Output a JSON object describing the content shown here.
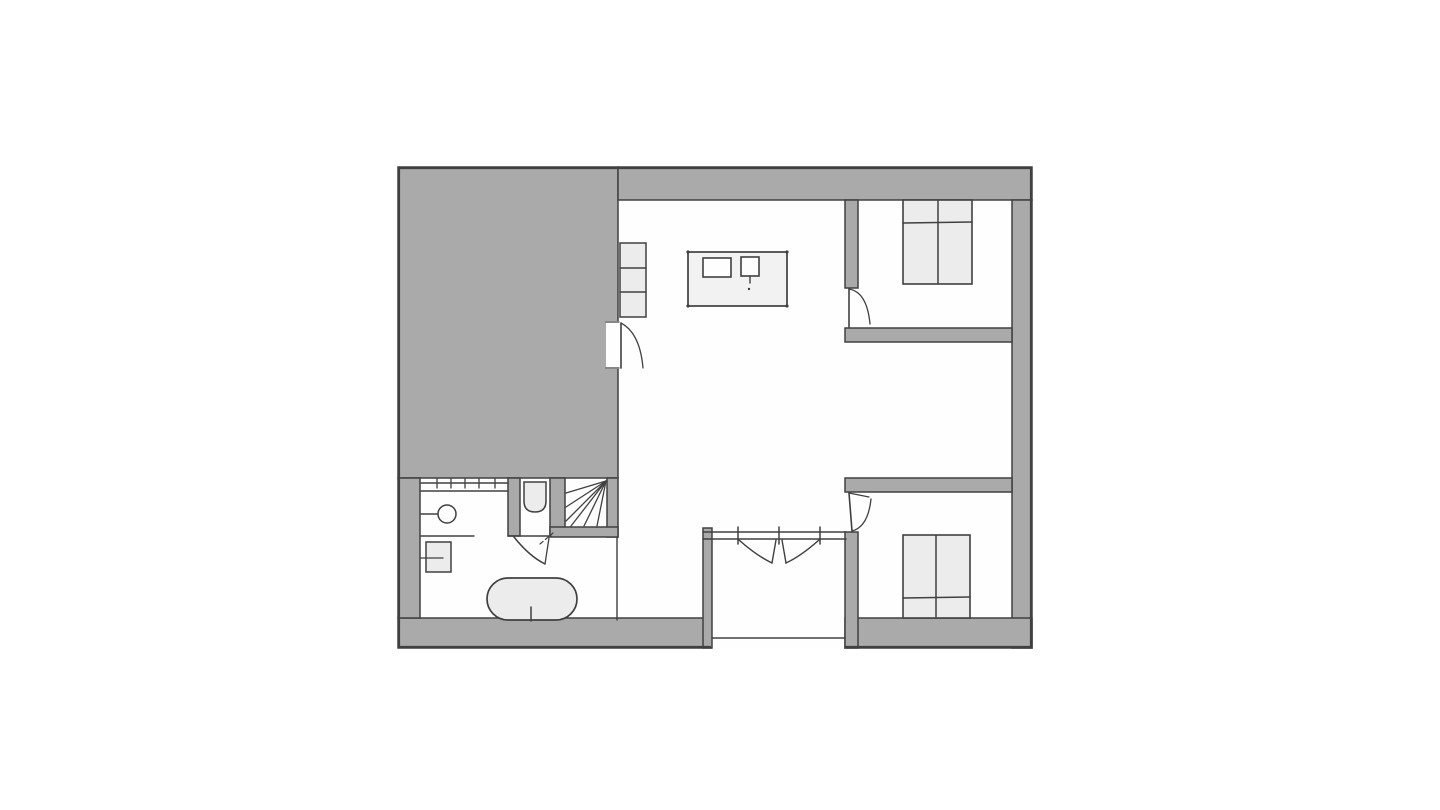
{
  "document": {
    "kind": "architectural floor plan, hand-drawn style, no text labels",
    "rooms": [
      "living-kitchen room",
      "bedroom top-right",
      "bedroom bottom-right",
      "bathroom",
      "wc",
      "stairwell",
      "entrance vestibule"
    ],
    "annex_note": "large solid gray block occupies top-left quadrant"
  },
  "colors": {
    "background": "#ffffff",
    "paper": "#fefefe",
    "wall": "#aaaaaa",
    "line": "#404040",
    "furniture": "#ececec",
    "island": "#f2f2f2"
  },
  "floorplan": {
    "canvas": {
      "width": 1440,
      "height": 810
    },
    "shapes": [
      {
        "name": "plan-paper",
        "type": "rect",
        "x": 398,
        "y": 167,
        "w": 634,
        "h": 481,
        "fill": "paper"
      },
      {
        "name": "gray-annex-block",
        "type": "rect",
        "x": 398,
        "y": 167,
        "w": 220,
        "h": 311,
        "fill": "wall",
        "stroke": "line",
        "sw": 1.5
      },
      {
        "name": "wall-top",
        "type": "rect",
        "x": 618,
        "y": 167,
        "w": 414,
        "h": 33,
        "fill": "wall",
        "stroke": "line",
        "sw": 1.5
      },
      {
        "name": "wall-right",
        "type": "rect",
        "x": 1012,
        "y": 200,
        "w": 20,
        "h": 448,
        "fill": "wall",
        "stroke": "line",
        "sw": 1.5
      },
      {
        "name": "wall-bottom-left",
        "type": "rect",
        "x": 398,
        "y": 618,
        "w": 313,
        "h": 30,
        "fill": "wall",
        "stroke": "line",
        "sw": 1.5
      },
      {
        "name": "wall-bottom-right",
        "type": "rect",
        "x": 845,
        "y": 618,
        "w": 187,
        "h": 30,
        "fill": "wall",
        "stroke": "line",
        "sw": 1.5
      },
      {
        "name": "wall-bathroom-left",
        "type": "rect",
        "x": 398,
        "y": 478,
        "w": 22,
        "h": 140,
        "fill": "wall",
        "stroke": "line",
        "sw": 1.5
      },
      {
        "name": "wall-wc-left",
        "type": "rect",
        "x": 508,
        "y": 478,
        "w": 12,
        "h": 58,
        "fill": "wall",
        "stroke": "line",
        "sw": 1.5
      },
      {
        "name": "wall-wc-stair",
        "type": "rect",
        "x": 550,
        "y": 478,
        "w": 15,
        "h": 58,
        "fill": "wall",
        "stroke": "line",
        "sw": 1.5
      },
      {
        "name": "wall-stair-right",
        "type": "rect",
        "x": 607,
        "y": 478,
        "w": 11,
        "h": 59,
        "fill": "wall",
        "stroke": "line",
        "sw": 1.5
      },
      {
        "name": "wall-stair-bottom",
        "type": "rect",
        "x": 550,
        "y": 527,
        "w": 68,
        "h": 10,
        "fill": "wall",
        "stroke": "line",
        "sw": 1.5
      },
      {
        "name": "wall-vestibule-left",
        "type": "rect",
        "x": 703,
        "y": 528,
        "w": 9,
        "h": 120,
        "fill": "wall",
        "stroke": "line",
        "sw": 1.5
      },
      {
        "name": "wall-bedroom1-left",
        "type": "rect",
        "x": 845,
        "y": 200,
        "w": 13,
        "h": 88,
        "fill": "wall",
        "stroke": "line",
        "sw": 1.5
      },
      {
        "name": "wall-bedroom1-bottom",
        "type": "rect",
        "x": 845,
        "y": 328,
        "w": 167,
        "h": 14,
        "fill": "wall",
        "stroke": "line",
        "sw": 1.5
      },
      {
        "name": "wall-bedroom2-top",
        "type": "rect",
        "x": 845,
        "y": 478,
        "w": 167,
        "h": 14,
        "fill": "wall",
        "stroke": "line",
        "sw": 1.5
      },
      {
        "name": "wall-bedroom2-left",
        "type": "rect",
        "x": 845,
        "y": 532,
        "w": 13,
        "h": 116,
        "fill": "wall",
        "stroke": "line",
        "sw": 1.5
      },
      {
        "name": "outline-top",
        "type": "line",
        "p": [
          399,
          168,
          1031,
          168
        ],
        "stroke": "line",
        "sw": 2.2
      },
      {
        "name": "outline-left",
        "type": "line",
        "p": [
          399,
          168,
          399,
          647
        ],
        "stroke": "line",
        "sw": 2.2
      },
      {
        "name": "outline-right",
        "type": "line",
        "p": [
          1031,
          168,
          1031,
          647
        ],
        "stroke": "line",
        "sw": 2.2
      },
      {
        "name": "outline-bottom-left",
        "type": "line",
        "p": [
          399,
          647,
          710,
          647
        ],
        "stroke": "line",
        "sw": 2.2
      },
      {
        "name": "outline-bottom-right",
        "type": "line",
        "p": [
          846,
          647,
          1031,
          647
        ],
        "stroke": "line",
        "sw": 2.2
      },
      {
        "name": "living-room-door-opening",
        "type": "rect",
        "x": 606,
        "y": 321,
        "w": 13,
        "h": 48,
        "fill": "paper"
      },
      {
        "name": "living-room-door-jamb-top",
        "type": "line",
        "p": [
          606,
          322,
          619,
          322
        ],
        "stroke": "line",
        "sw": 1.3
      },
      {
        "name": "living-room-door-jamb-bottom",
        "type": "line",
        "p": [
          606,
          368,
          619,
          368
        ],
        "stroke": "line",
        "sw": 1.3
      },
      {
        "name": "living-room-door-leaf",
        "type": "line",
        "p": [
          621,
          323,
          621,
          368
        ],
        "stroke": "line",
        "sw": 1.6
      },
      {
        "name": "living-room-door-swing",
        "type": "path",
        "d": "M621,323 Q640,333 643,368",
        "stroke": "line",
        "sw": 1.3
      },
      {
        "name": "shelf-unit",
        "type": "rect",
        "x": 620,
        "y": 243,
        "w": 26,
        "h": 74,
        "fill": "furniture",
        "stroke": "line",
        "sw": 1.5
      },
      {
        "name": "shelf-divider-1",
        "type": "line",
        "p": [
          620,
          268,
          646,
          268
        ],
        "stroke": "line",
        "sw": 1.4
      },
      {
        "name": "shelf-divider-2",
        "type": "line",
        "p": [
          620,
          292,
          646,
          292
        ],
        "stroke": "line",
        "sw": 1.4
      },
      {
        "name": "kitchen-island",
        "type": "rect",
        "x": 688,
        "y": 252,
        "w": 99,
        "h": 54,
        "fill": "island",
        "stroke": "line",
        "sw": 1.7
      },
      {
        "name": "island-corner-dot-1",
        "type": "circle",
        "cx": 688,
        "cy": 252,
        "r": 1.6,
        "fill": "line"
      },
      {
        "name": "island-corner-dot-2",
        "type": "circle",
        "cx": 787,
        "cy": 252,
        "r": 1.6,
        "fill": "line"
      },
      {
        "name": "island-corner-dot-3",
        "type": "circle",
        "cx": 688,
        "cy": 306,
        "r": 1.6,
        "fill": "line"
      },
      {
        "name": "island-corner-dot-4",
        "type": "circle",
        "cx": 787,
        "cy": 306,
        "r": 1.6,
        "fill": "line"
      },
      {
        "name": "cooktop",
        "type": "rect",
        "x": 703,
        "y": 258,
        "w": 28,
        "h": 19,
        "fill": "paper",
        "stroke": "line",
        "sw": 1.6
      },
      {
        "name": "kitchen-sink",
        "type": "rect",
        "x": 741,
        "y": 257,
        "w": 18,
        "h": 19,
        "fill": "paper",
        "stroke": "line",
        "sw": 1.6
      },
      {
        "name": "kitchen-sink-tap",
        "type": "line",
        "p": [
          750,
          276,
          750,
          283
        ],
        "stroke": "line",
        "sw": 1.4
      },
      {
        "name": "kitchen-sink-dot",
        "type": "circle",
        "cx": 749,
        "cy": 289,
        "r": 1.2,
        "fill": "line"
      },
      {
        "name": "bed-top-bedroom",
        "type": "rect",
        "x": 903,
        "y": 200,
        "w": 69,
        "h": 84,
        "fill": "furniture",
        "stroke": "line",
        "sw": 1.6
      },
      {
        "name": "bed-top-divider",
        "type": "line",
        "p": [
          938,
          201,
          938,
          283
        ],
        "stroke": "line",
        "sw": 1.5
      },
      {
        "name": "bed-top-pillow-line",
        "type": "line",
        "p": [
          903,
          223,
          972,
          222
        ],
        "stroke": "line",
        "sw": 1.6
      },
      {
        "name": "bed-bottom-bedroom",
        "type": "rect",
        "x": 903,
        "y": 535,
        "w": 67,
        "h": 83,
        "fill": "furniture",
        "stroke": "line",
        "sw": 1.6
      },
      {
        "name": "bed-bottom-divider",
        "type": "line",
        "p": [
          936,
          536,
          936,
          617
        ],
        "stroke": "line",
        "sw": 1.5
      },
      {
        "name": "bed-bottom-pillow-line",
        "type": "line",
        "p": [
          903,
          598,
          970,
          597
        ],
        "stroke": "line",
        "sw": 1.6
      },
      {
        "name": "bathtub",
        "type": "rect",
        "x": 487,
        "y": 578,
        "w": 90,
        "h": 42,
        "rx": 21,
        "fill": "furniture",
        "stroke": "line",
        "sw": 1.7
      },
      {
        "name": "bathtub-tap",
        "type": "line",
        "p": [
          531,
          607,
          531,
          621
        ],
        "stroke": "line",
        "sw": 1.5
      },
      {
        "name": "washbasin-wall-line",
        "type": "line",
        "p": [
          421,
          514,
          439,
          514
        ],
        "stroke": "line",
        "sw": 1.4
      },
      {
        "name": "washbasin",
        "type": "circle",
        "cx": 447,
        "cy": 514,
        "r": 9,
        "fill": "paper",
        "stroke": "line",
        "sw": 1.5
      },
      {
        "name": "bathroom-counter-line",
        "type": "line",
        "p": [
          421,
          536,
          474,
          536
        ],
        "stroke": "line",
        "sw": 1.4
      },
      {
        "name": "bathroom-cabinet",
        "type": "rect",
        "x": 426,
        "y": 542,
        "w": 25,
        "h": 30,
        "fill": "furniture",
        "stroke": "line",
        "sw": 1.5
      },
      {
        "name": "bathroom-cabinet-divider",
        "type": "line",
        "p": [
          421,
          558,
          443,
          558
        ],
        "stroke": "line",
        "sw": 1.3
      },
      {
        "name": "toilet",
        "type": "path",
        "d": "M524,482 L524,501 Q524,512 535,512 Q546,512 546,501 L546,482 Z",
        "fill": "furniture",
        "stroke": "line",
        "sw": 1.5
      },
      {
        "name": "stair-tread-1",
        "type": "line",
        "p": [
          606,
          481,
          566,
          493
        ],
        "stroke": "line",
        "sw": 1.3
      },
      {
        "name": "stair-tread-2",
        "type": "line",
        "p": [
          606,
          481,
          566,
          507
        ],
        "stroke": "line",
        "sw": 1.3
      },
      {
        "name": "stair-tread-3",
        "type": "line",
        "p": [
          606,
          481,
          566,
          521
        ],
        "stroke": "line",
        "sw": 1.3
      },
      {
        "name": "stair-tread-4",
        "type": "line",
        "p": [
          606,
          481,
          571,
          526
        ],
        "stroke": "line",
        "sw": 1.3
      },
      {
        "name": "stair-tread-5",
        "type": "line",
        "p": [
          606,
          481,
          584,
          526
        ],
        "stroke": "line",
        "sw": 1.3
      },
      {
        "name": "stair-tread-6",
        "type": "line",
        "p": [
          606,
          481,
          597,
          526
        ],
        "stroke": "line",
        "sw": 1.3
      },
      {
        "name": "hall-partition-line",
        "type": "line",
        "p": [
          617,
          537,
          617,
          620
        ],
        "stroke": "line",
        "sw": 1.4
      },
      {
        "name": "bathroom-window-line-outer",
        "type": "line",
        "p": [
          421,
          483,
          508,
          483
        ],
        "stroke": "line",
        "sw": 1.4
      },
      {
        "name": "bathroom-window-line-inner",
        "type": "line",
        "p": [
          421,
          491,
          508,
          491
        ],
        "stroke": "line",
        "sw": 1.4
      },
      {
        "name": "bathroom-window-tick-1",
        "type": "line",
        "p": [
          437,
          479,
          437,
          488
        ],
        "stroke": "line",
        "sw": 1.3
      },
      {
        "name": "bathroom-window-tick-2",
        "type": "line",
        "p": [
          451,
          479,
          451,
          488
        ],
        "stroke": "line",
        "sw": 1.3
      },
      {
        "name": "bathroom-window-tick-3",
        "type": "line",
        "p": [
          465,
          479,
          465,
          488
        ],
        "stroke": "line",
        "sw": 1.3
      },
      {
        "name": "bathroom-window-tick-4",
        "type": "line",
        "p": [
          479,
          479,
          479,
          488
        ],
        "stroke": "line",
        "sw": 1.3
      },
      {
        "name": "bathroom-window-tick-5",
        "type": "line",
        "p": [
          495,
          479,
          495,
          488
        ],
        "stroke": "line",
        "sw": 1.3
      },
      {
        "name": "wc-door-head-line",
        "type": "line",
        "p": [
          508,
          536,
          551,
          536
        ],
        "stroke": "line",
        "sw": 1.4
      },
      {
        "name": "wc-door-leaf",
        "type": "path",
        "d": "M514,537 Q529,556 545,564",
        "stroke": "line",
        "sw": 1.5
      },
      {
        "name": "wc-door-edge",
        "type": "line",
        "p": [
          545,
          564,
          549,
          538
        ],
        "stroke": "line",
        "sw": 1.3
      },
      {
        "name": "wc-door-dash",
        "type": "path",
        "d": "M540,544 L553,533",
        "stroke": "line",
        "sw": 1.2,
        "dash": "4 3"
      },
      {
        "name": "vestibule-glass-line-top",
        "type": "line",
        "p": [
          703,
          532,
          846,
          532
        ],
        "stroke": "line",
        "sw": 1.6
      },
      {
        "name": "vestibule-glass-line-bottom",
        "type": "line",
        "p": [
          703,
          539,
          846,
          539
        ],
        "stroke": "line",
        "sw": 1.6
      },
      {
        "name": "vestibule-jamb-tick-1",
        "type": "line",
        "p": [
          738,
          527,
          738,
          544
        ],
        "stroke": "line",
        "sw": 1.5
      },
      {
        "name": "vestibule-jamb-tick-2",
        "type": "line",
        "p": [
          779,
          527,
          779,
          544
        ],
        "stroke": "line",
        "sw": 1.5
      },
      {
        "name": "vestibule-jamb-tick-3",
        "type": "line",
        "p": [
          820,
          527,
          820,
          544
        ],
        "stroke": "line",
        "sw": 1.5
      },
      {
        "name": "entrance-threshold",
        "type": "line",
        "p": [
          712,
          638,
          845,
          638
        ],
        "stroke": "line",
        "sw": 1.6
      },
      {
        "name": "bedroom1-door-leaf",
        "type": "line",
        "p": [
          849,
          289,
          849,
          327
        ],
        "stroke": "line",
        "sw": 1.6
      },
      {
        "name": "bedroom1-door-swing",
        "type": "path",
        "d": "M849,289 Q867,292 870,324",
        "stroke": "line",
        "sw": 1.3
      },
      {
        "name": "bedroom2-door-leaf",
        "type": "line",
        "p": [
          849,
          493,
          852,
          531
        ],
        "stroke": "line",
        "sw": 1.6
      },
      {
        "name": "bedroom2-door-top",
        "type": "line",
        "p": [
          849,
          493,
          869,
          497
        ],
        "stroke": "line",
        "sw": 1.2
      },
      {
        "name": "bedroom2-door-swing",
        "type": "path",
        "d": "M852,531 Q868,527 871,499",
        "stroke": "line",
        "sw": 1.3
      },
      {
        "name": "entry-door-left-leaf",
        "type": "path",
        "d": "M739,540 Q757,556 772,563",
        "stroke": "line",
        "sw": 1.5
      },
      {
        "name": "entry-door-left-edge",
        "type": "line",
        "p": [
          772,
          563,
          776,
          540
        ],
        "stroke": "line",
        "sw": 1.4
      },
      {
        "name": "entry-door-right-leaf",
        "type": "path",
        "d": "M819,540 Q801,556 786,563",
        "stroke": "line",
        "sw": 1.5
      },
      {
        "name": "entry-door-right-edge",
        "type": "line",
        "p": [
          786,
          563,
          782,
          540
        ],
        "stroke": "line",
        "sw": 1.4
      }
    ]
  }
}
